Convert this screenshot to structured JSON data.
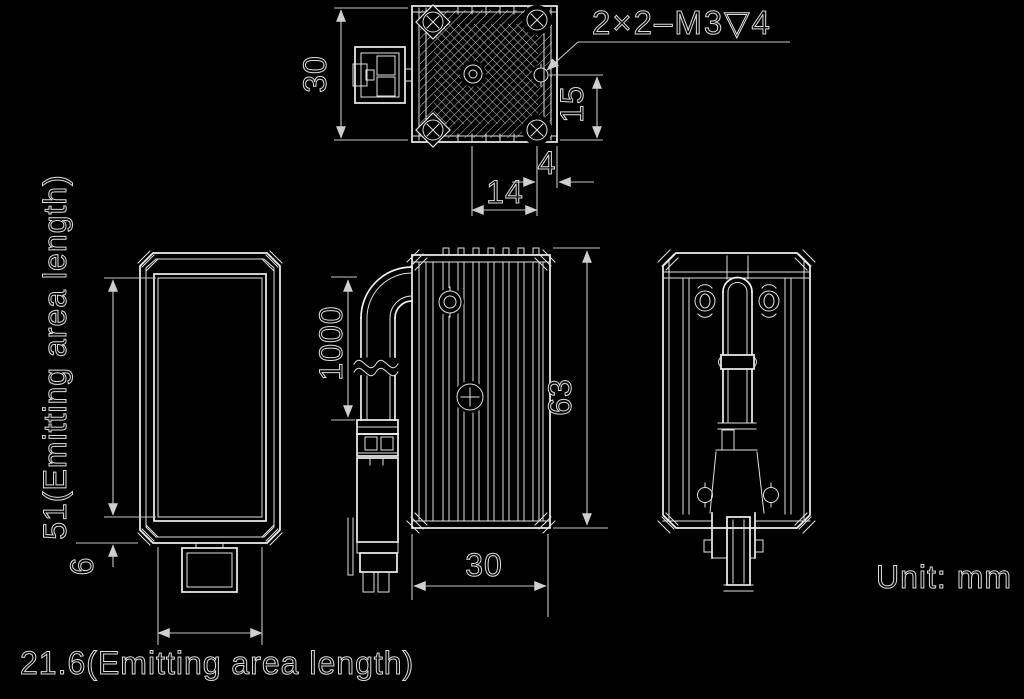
{
  "unit_note": "Unit: mm",
  "top_view": {
    "thread_callout": "2×2–M3▽4",
    "width_mm": "30",
    "hole_row_offset_mm": "15",
    "hole_pitch_mm": "14",
    "hole_edge_offset_mm": "4"
  },
  "front_view": {
    "emitting_height": "51(Emitting area length)",
    "below_window_mm": "6",
    "emitting_width": "21.6(Emitting area length)"
  },
  "side_view": {
    "cable_length_mm": "1000",
    "height_mm": "63",
    "depth_mm": "30"
  }
}
